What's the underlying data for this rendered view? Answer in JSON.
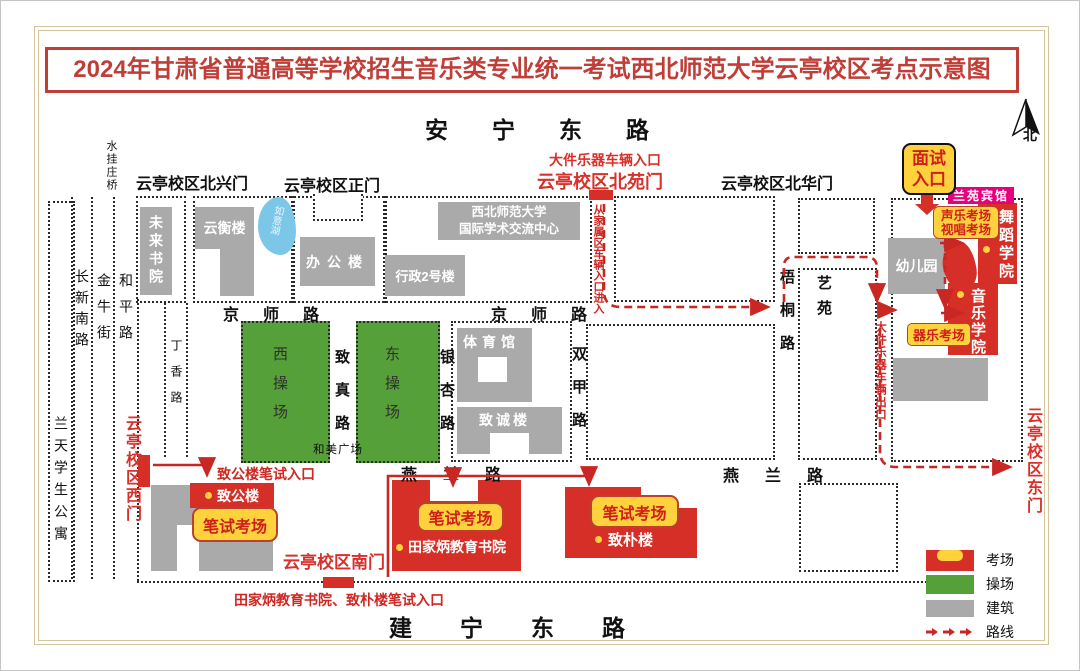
{
  "title": "2024年甘肃省普通高等学校招生音乐类专业统一考试西北师范大学云亭校区考点示意图",
  "compass_label": "北",
  "colors": {
    "exam_red": "#d52f27",
    "field_green": "#55a038",
    "building_gray": "#aaaaaa",
    "highlight_yellow": "#ffd23d",
    "hotel_magenta": "#e6007e",
    "route_red": "#c92723",
    "lake_blue": "#7cc7e8",
    "title_red": "#bf3e38"
  },
  "roads": {
    "anning": "安宁东路",
    "jianning": "建宁东路",
    "jingshi_west": "京师路",
    "jingshi_east": "京师路",
    "yanlan_west": "燕兰路",
    "yanlan_east": "燕兰路",
    "zhizhen": "致真路",
    "yinxing": "银杏路",
    "shuangjia": "双甲路",
    "wutong": "梧桐路",
    "changxin": "长新南路",
    "jinniu": "金牛街",
    "heping": "和平路",
    "dingxiang": "丁香路",
    "shuiguazhuang": "水挂庄桥",
    "hemei": "和美广场"
  },
  "gates": {
    "beixing": "云亭校区北兴门",
    "zheng": "云亭校区正门",
    "beiyuan": "云亭校区北苑门",
    "beiyuan_note": "大件乐器车辆入口",
    "beihua": "云亭校区北华门",
    "west": "云亭校区西门",
    "south": "云亭校区南门",
    "east": "云亭校区东门"
  },
  "buildings": {
    "weilai": "未来书院",
    "yunheng": "云衡楼",
    "ruyi_lake": "如意湖",
    "bangong": "办公楼",
    "xingzheng": "行政2号楼",
    "guoji_line1": "西北师范大学",
    "guoji_line2": "国际学术交流中心",
    "tiyuguan": "体育馆",
    "zhicheng": "致诚楼",
    "youeryuan": "幼儿园",
    "yiyuan": "艺苑",
    "lantian": "兰天学生公寓",
    "xicaochang": "西操场",
    "dongcaochang": "东操场",
    "zhigong": "致公楼",
    "tianjiabing": "田家炳教育书院",
    "zhipu": "致朴楼",
    "wudao": "舞蹈学院",
    "yinyue": "音乐学院",
    "lanyuan": "兰苑宾馆"
  },
  "exam_labels": {
    "mianshi_line1": "面试",
    "mianshi_line2": "入口",
    "shengyue_line1": "声乐考场",
    "shengyue_line2": "视唱考场",
    "qiyue": "器乐考场",
    "bishi_zhigong": "笔试考场",
    "bishi_tianjiabing": "笔试考场",
    "bishi_zhipu": "笔试考场"
  },
  "route_notes": {
    "jiashu_note": "从家属区车辆入口进入",
    "dajian_exit": "大件乐器车辆出口",
    "zhigong_entry": "致公楼笔试入口",
    "south_entry": "田家炳教育书院、致朴楼笔试入口"
  },
  "legend": {
    "kaochang": "考场",
    "caochang": "操场",
    "jianzhu": "建筑",
    "luxian": "路线"
  }
}
